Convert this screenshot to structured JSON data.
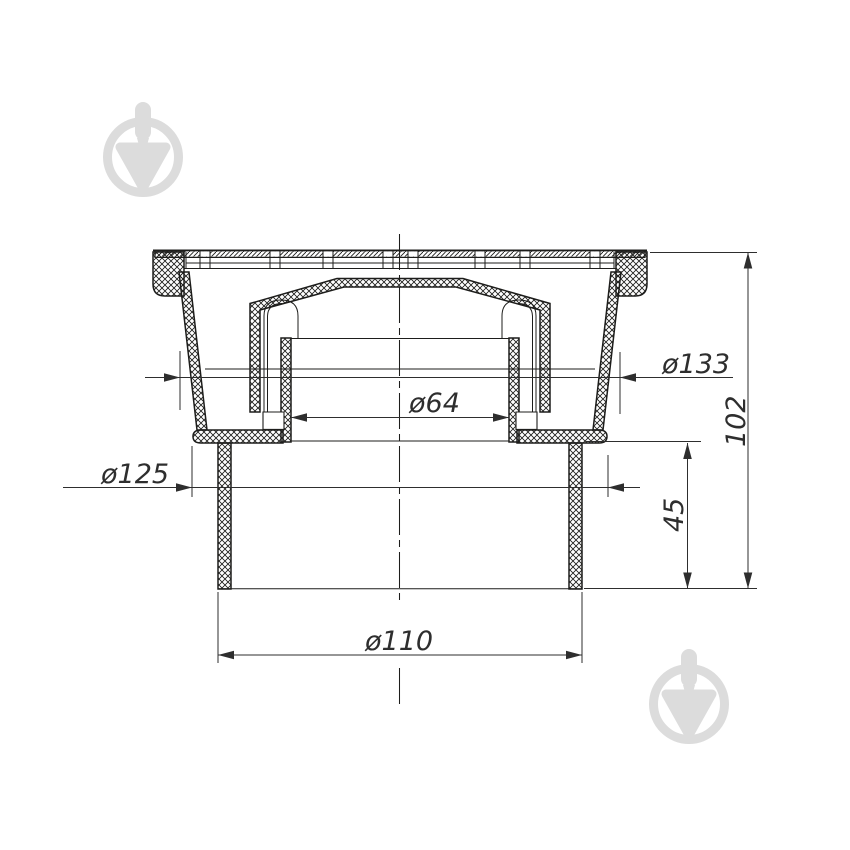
{
  "colors": {
    "line": "#1d1d1b",
    "dim": "#2e2e2e",
    "watermark": "#dcdcdc",
    "background": "#ffffff"
  },
  "drawing": {
    "type": "technical-section-drawing",
    "dims": {
      "d133": {
        "label": "ø133",
        "value": 133,
        "kind": "diameter",
        "orientation": "horizontal"
      },
      "d64": {
        "label": "ø64",
        "value": 64,
        "kind": "diameter",
        "orientation": "horizontal"
      },
      "d125": {
        "label": "ø125",
        "value": 125,
        "kind": "diameter",
        "orientation": "horizontal"
      },
      "d110": {
        "label": "ø110",
        "value": 110,
        "kind": "diameter",
        "orientation": "horizontal"
      },
      "h45": {
        "label": "45",
        "value": 45,
        "kind": "linear",
        "orientation": "vertical"
      },
      "h102": {
        "label": "102",
        "value": 102,
        "kind": "linear",
        "orientation": "vertical"
      }
    }
  },
  "watermark": {
    "icon": "trowel-in-circle",
    "positions": [
      "top-left",
      "bottom-right"
    ]
  }
}
